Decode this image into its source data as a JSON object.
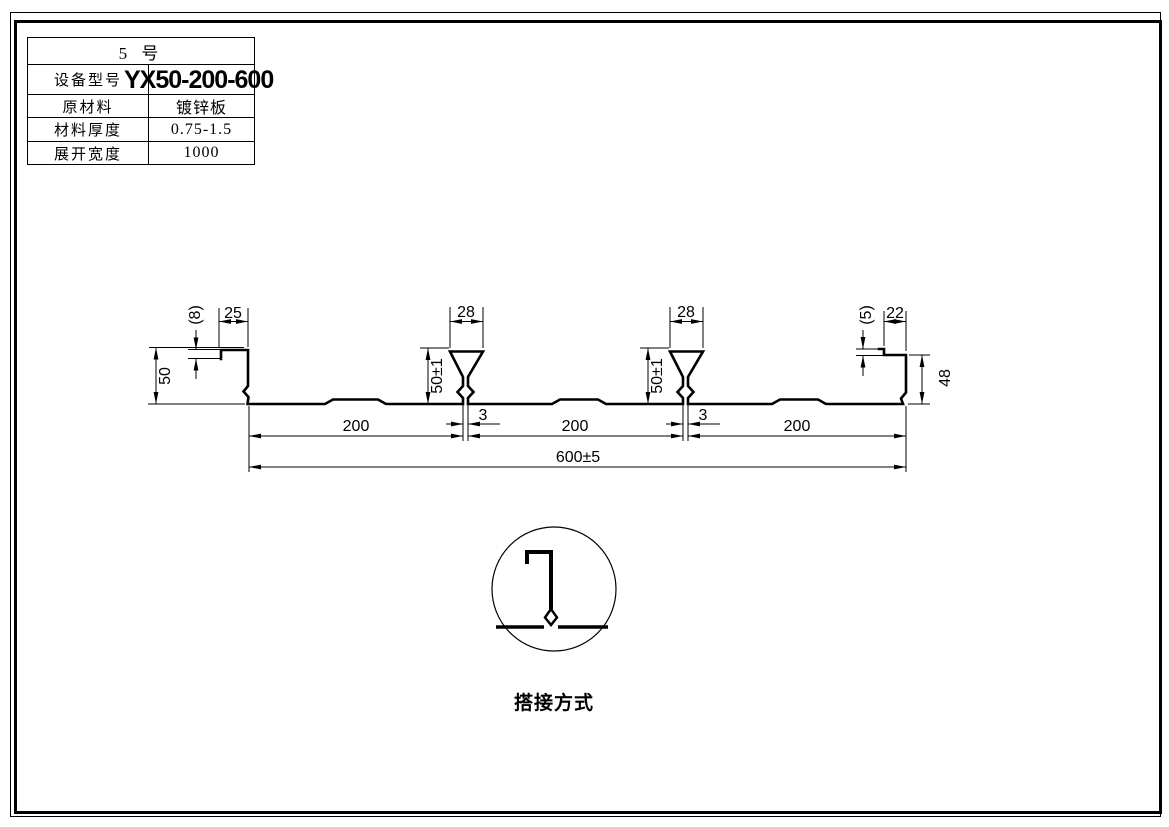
{
  "table": {
    "header": "5 号",
    "rows": [
      {
        "label": "设备型号",
        "value": "YX50-200-600"
      },
      {
        "label": "原材料",
        "value": "镀锌板"
      },
      {
        "label": "材料厚度",
        "value": "0.75-1.5"
      },
      {
        "label": "展开宽度",
        "value": "1000"
      }
    ]
  },
  "drawing": {
    "dims": {
      "left_lip_return": "(8)",
      "left_lip_width": "25",
      "left_height": "50",
      "rib1_width": "28",
      "rib1_height": "50±1",
      "rib1_stem": "3",
      "rib2_width": "28",
      "rib2_height": "50±1",
      "rib2_stem": "3",
      "right_lip_return": "(5)",
      "right_lip_width": "22",
      "right_height": "48",
      "span1": "200",
      "span2": "200",
      "span3": "200",
      "total_width": "600±5"
    },
    "detail_label": "搭接方式"
  },
  "colors": {
    "line": "#000000",
    "background": "#ffffff"
  }
}
